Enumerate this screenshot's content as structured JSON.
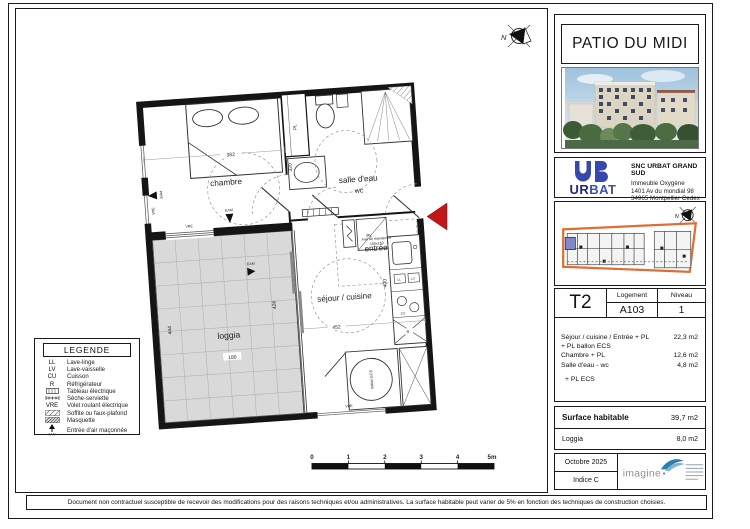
{
  "sheet": {
    "project_title": "PATIO DU MIDI",
    "north_label": "N",
    "disclaimer": "Document non contractuel susceptible de recevoir des modifications pour des raisons techniques et/ou administratives. La surface habitable peut varier de 5% en fonction des techniques de construction choisies."
  },
  "company": {
    "name": "SNC URBAT GRAND SUD",
    "logo_ur": "UR",
    "logo_bat": "BAT",
    "address": [
      "Immeuble Oxygène",
      "1401 Av du mondial 98",
      "34965 Montpellier Cedex 2",
      "Tél 04.67.14.13.12"
    ]
  },
  "unit": {
    "type": "T2",
    "logement_label": "Logement",
    "logement": "A103",
    "niveau_label": "Niveau",
    "niveau": "1"
  },
  "areas": {
    "rows": [
      {
        "label": "Séjour / cuisine / Entrée + PL",
        "value": "22,3 m2"
      },
      {
        "label": "+ PL ballon ECS",
        "value": ""
      },
      {
        "label": "Chambre  + PL",
        "value": "12,6 m2"
      },
      {
        "label": "Salle d'eau - wc",
        "value": "4,8 m2"
      }
    ],
    "note": "+ PL ECS",
    "surface_label": "Surface habitable",
    "surface_value": "39,7 m2",
    "loggia_label": "Loggia",
    "loggia_value": "8,0 m2"
  },
  "revision": {
    "date": "Octobre 2025",
    "indice": "Indice C",
    "architect": "imagine"
  },
  "legend": {
    "title": "LEGENDE",
    "items": [
      {
        "code": "LL",
        "label": "Lave-linge"
      },
      {
        "code": "LV",
        "label": "Lave-vaisselle"
      },
      {
        "code": "CU",
        "label": "Cuisson"
      },
      {
        "code": "R",
        "label": "Réfrigérateur"
      },
      {
        "code": "",
        "label": "Tableau électrique"
      },
      {
        "code": "",
        "label": "Sèche-serviette"
      },
      {
        "code": "VRE",
        "label": "Volet roulant électrique"
      },
      {
        "code": "",
        "label": "Soffite ou faux-plafond"
      },
      {
        "code": "",
        "label": "Masquette"
      },
      {
        "code": "",
        "label": "Entrée d'air maçonnée"
      }
    ],
    "eam_caption": "EAM"
  },
  "plan": {
    "rooms": {
      "chambre": "chambre",
      "salle_deau": "salle d'eau",
      "wc": "wc",
      "entree": "entrée",
      "sejour": "séjour / cuisine",
      "loggia": "loggia"
    },
    "dims": {
      "d382": "382",
      "d320": "320",
      "d426": "426",
      "d452": "452",
      "d400": "400",
      "d444": "444",
      "d180": "180"
    },
    "labels": {
      "pl": "PL",
      "eam": "EAM",
      "vre": "VRE",
      "ballon": "ballon ECS",
      "aire1": "Aire de manœuvre",
      "aire2": "150x150",
      "ll": "LL",
      "lv": "LV",
      "cu": "CU",
      "r": "R"
    }
  },
  "scalebar": {
    "labels": [
      "0",
      "1",
      "2",
      "3",
      "4",
      "5m"
    ]
  }
}
